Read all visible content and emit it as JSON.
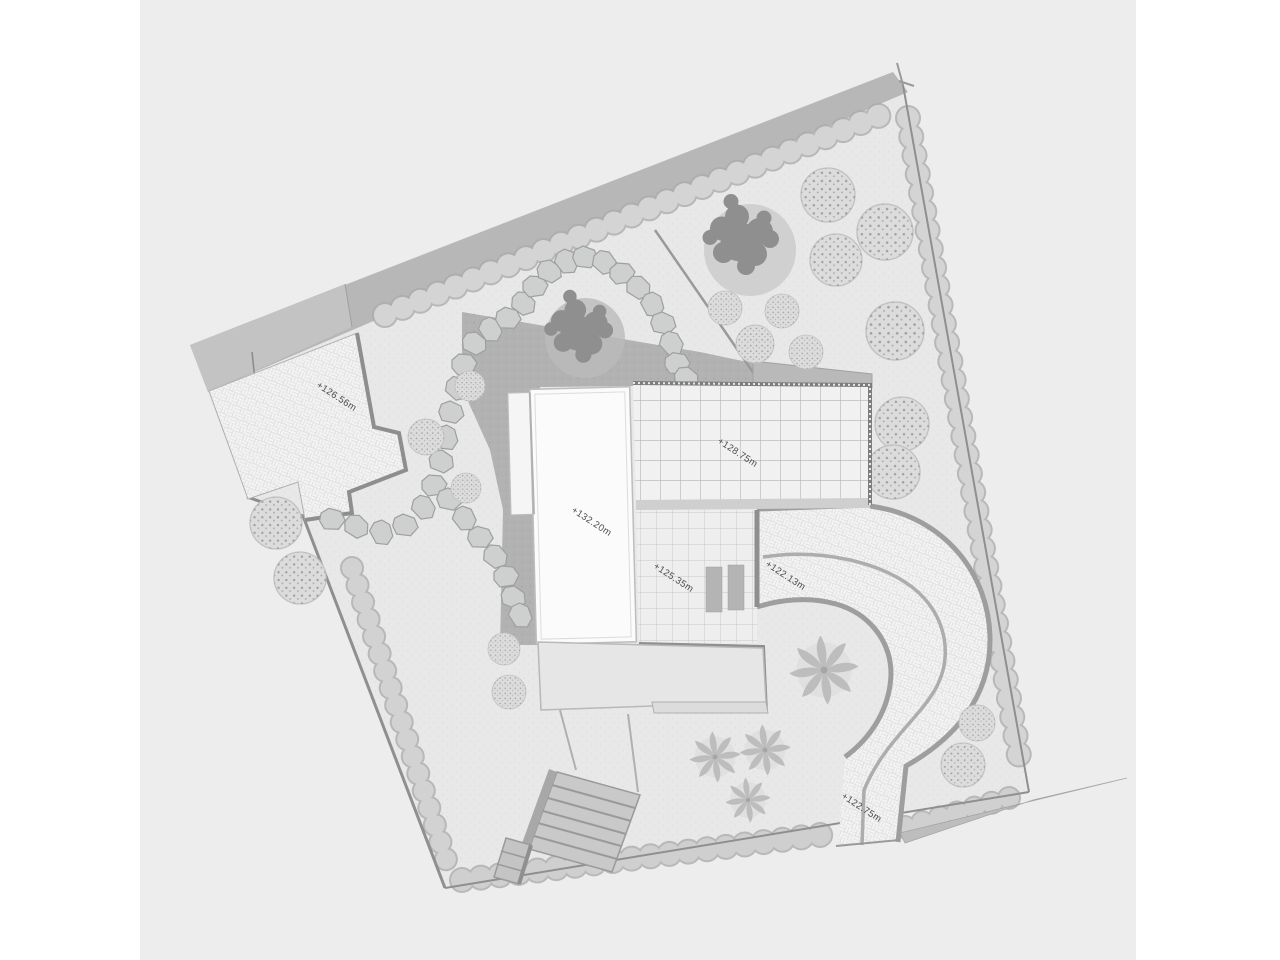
{
  "drawing": {
    "kind_label": "residential landscape site plan",
    "labels": {
      "parking_level": "+126.56m",
      "house_roof_level": "+132.20m",
      "glass_roof_level": "+128.75m",
      "terrace_level": "+125.35m",
      "driveway_level": "+122.13m",
      "driveway_exit_level": "+122.75m"
    },
    "palette": {
      "sheet": "#ededed",
      "margin": "#ffffff",
      "ground": "#e8e8e8",
      "road_band": "#b7b7b7",
      "wall": "#8f8f8f",
      "lawn_dark": "#b2b2b2",
      "paving_base": "#e2e2e2",
      "paving_tile": "#f4f4f4",
      "hedge": "#d4d4d4",
      "building": "#fafafa",
      "label_text": "#4d4d4d"
    }
  }
}
